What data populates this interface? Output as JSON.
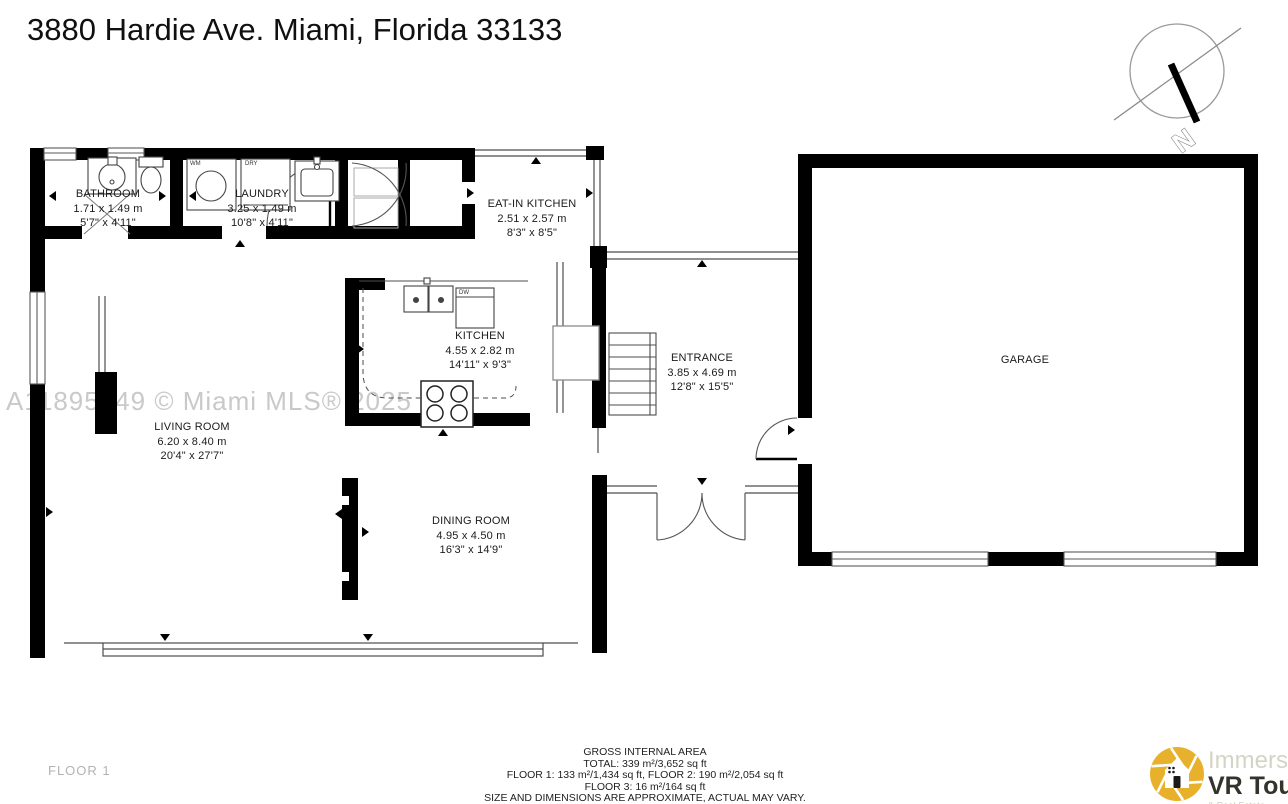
{
  "title": "3880 Hardie Ave. Miami, Florida 33133",
  "watermark": "A11895349 © Miami MLS® 2025",
  "floor_label": "FLOOR 1",
  "compass": {
    "label": "N"
  },
  "rooms": [
    {
      "name": "BATHROOM",
      "metric": "1.71 x 1.49 m",
      "imperial": "5'7\" x 4'11\""
    },
    {
      "name": "LAUNDRY",
      "metric": "3.25 x 1.49 m",
      "imperial": "10'8\" x 4'11\""
    },
    {
      "name": "EAT-IN KITCHEN",
      "metric": "2.51 x 2.57 m",
      "imperial": "8'3\" x 8'5\""
    },
    {
      "name": "KITCHEN",
      "metric": "4.55 x 2.82 m",
      "imperial": "14'11\" x 9'3\""
    },
    {
      "name": "ENTRANCE",
      "metric": "3.85 x 4.69 m",
      "imperial": "12'8\" x 15'5\""
    },
    {
      "name": "GARAGE",
      "metric": "",
      "imperial": ""
    },
    {
      "name": "LIVING ROOM",
      "metric": "6.20 x 8.40 m",
      "imperial": "20'4\" x 27'7\""
    },
    {
      "name": "DINING ROOM",
      "metric": "4.95 x 4.50 m",
      "imperial": "16'3\" x 14'9\""
    }
  ],
  "fixtures": {
    "wm": "WM",
    "dry": "DRY",
    "dw": "DW"
  },
  "footer": {
    "lines": [
      "GROSS INTERNAL AREA",
      "TOTAL: 339 m²/3,652 sq ft",
      "FLOOR 1: 133 m²/1,434 sq ft, FLOOR 2: 190 m²/2,054 sq ft",
      "FLOOR 3: 16 m²/164 sq ft",
      "SIZE AND DIMENSIONS ARE APPROXIMATE, ACTUAL MAY VARY."
    ]
  },
  "logo": {
    "line1": "Immersive",
    "line2": "VR Tours",
    "line3": "& Real Estate Photography",
    "accent": "#E8B12B"
  },
  "colors": {
    "wall": "#000000",
    "thin": "#4d4d4d",
    "watermark": "#c9c9c9",
    "label": "#1b1b1b"
  }
}
